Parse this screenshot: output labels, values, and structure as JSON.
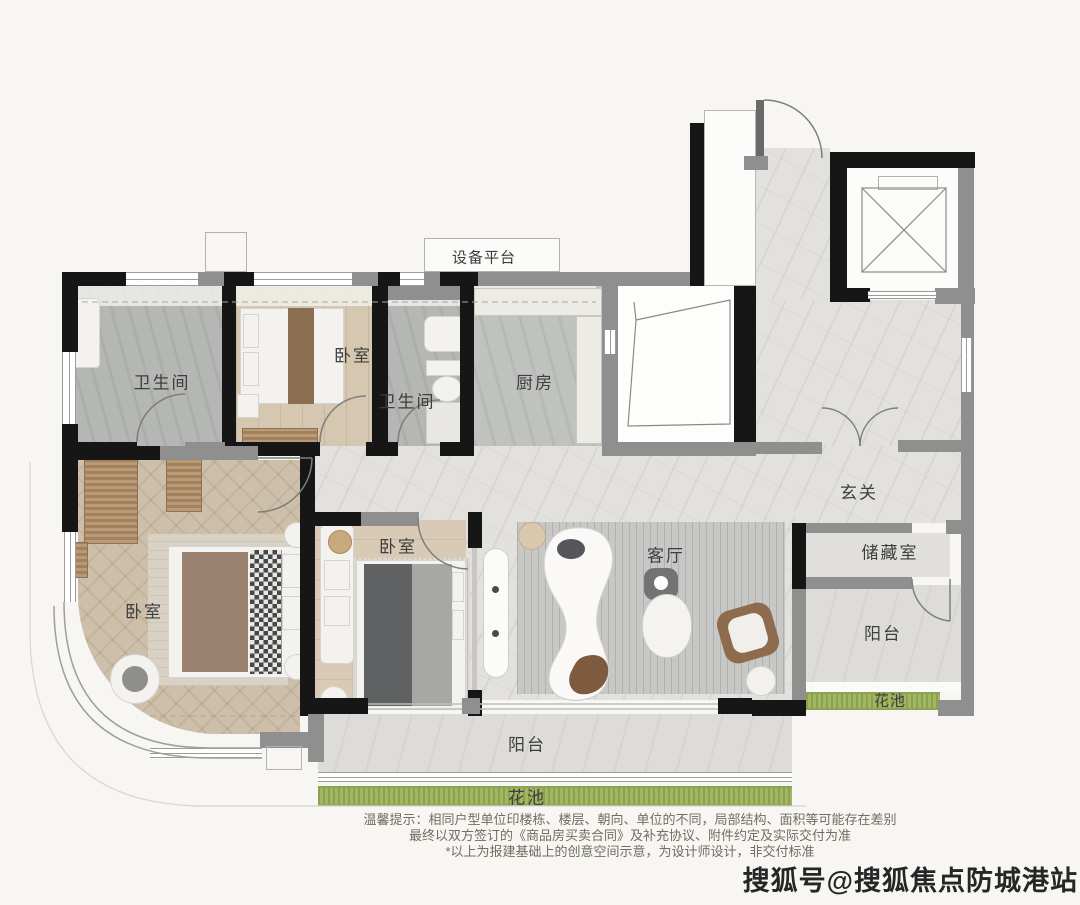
{
  "title": "户型平面图",
  "labels": {
    "equipment_platform": "设备平台",
    "bathroom1": "卫生间",
    "bedroom_top": "卧室",
    "bathroom2": "卫生间",
    "kitchen": "厨房",
    "entry": "玄关",
    "storage": "储藏室",
    "balcony_right": "阳台",
    "flowerbed_right": "花池",
    "master_bedroom": "卧室",
    "bedroom2": "卧室",
    "living_room": "客厅",
    "balcony_bottom": "阳台",
    "flowerbed_bottom": "花池"
  },
  "disclaimer": {
    "line1": "温馨提示：相同户型单位印楼栋、楼层、朝向、单位的不同，局部结构、面积等可能存在差别",
    "line2": "最终以双方签订的《商品房买卖合同》及补充协议、附件约定及实际交付为准",
    "line3": "*以上为报建基础上的创意空间示意，为设计师设计，非交付标准"
  },
  "watermark": "搜狐号@搜狐焦点防城港站",
  "colors": {
    "wall_black": "#161616",
    "wall_gray": "#8f8f8f",
    "marble_floor": "#e2e1de",
    "wood_floor": "#cdbfa9",
    "bath_floor": "#b4b7b3",
    "flowerbed_green": "#a2b762",
    "label_text": "#3e3e3e"
  }
}
